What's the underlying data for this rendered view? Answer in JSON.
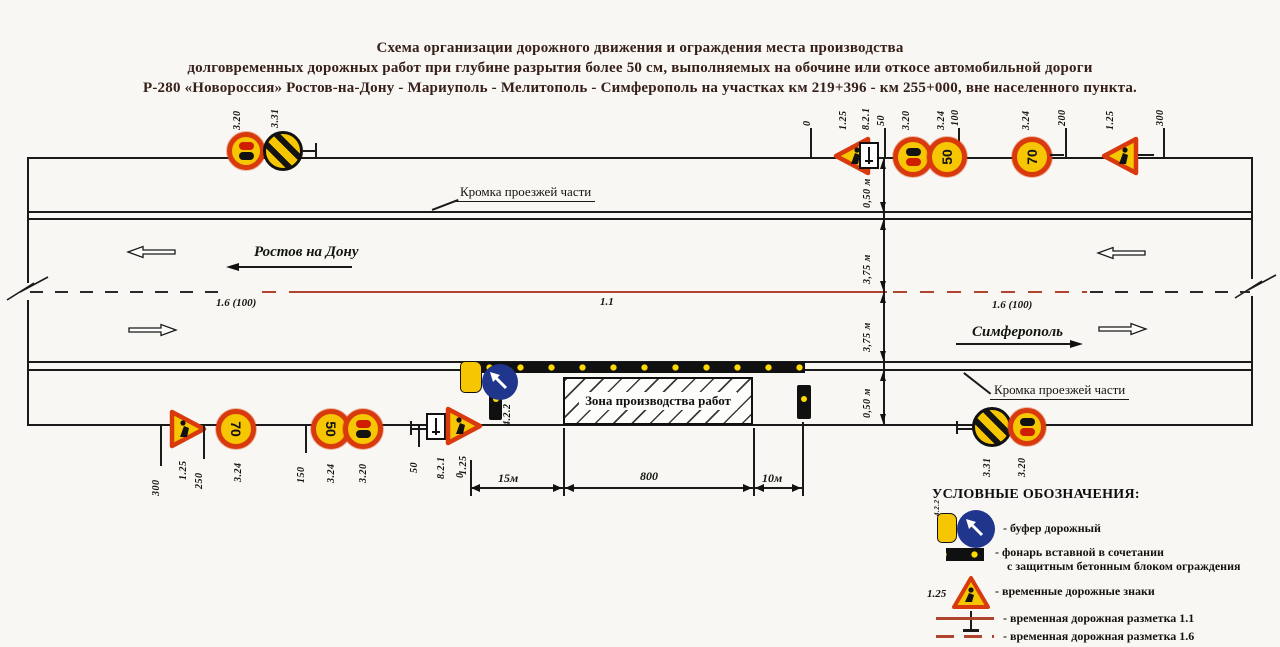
{
  "title": {
    "line1": "Схема организации дорожного движения и ограждения места производства",
    "line2": "долговременных дорожных работ при глубине разрытия более 50 см,  выполняемых на обочине или откосе автомобильной дороги",
    "line3": "Р-280 «Новороссия»  Ростов-на-Дону - Мариуполь - Мелитополь - Симферополь на участках км 219+396 - км 255+000, вне населенного пункта."
  },
  "road": {
    "kromka_top_label": "Кромка проезжей части",
    "kromka_bottom_label": "Кромка проезжей части",
    "dir_left": "Ростов на Дону",
    "dir_right": "Симферополь"
  },
  "markings": {
    "dash_left": "1.6 (100)",
    "solid_center": "1.1",
    "dash_right": "1.6 (100)"
  },
  "cross_section": [
    "0,50 м",
    "3,75 м",
    "3,75 м",
    "0,50 м"
  ],
  "stations": {
    "top": [
      "0",
      "50",
      "100",
      "200",
      "300"
    ],
    "bottom": [
      "300",
      "250",
      "150",
      "50",
      "0"
    ]
  },
  "work_zone": {
    "label": "Зона производства работ",
    "buffer_sign_label": "4.2.2",
    "zero_label": "0",
    "dims": {
      "before": "15м",
      "zone": "800",
      "after": "10м"
    }
  },
  "signs": {
    "tl": [
      {
        "id": "3.20"
      },
      {
        "id": "3.31"
      }
    ],
    "tr": [
      {
        "id": "1.25"
      },
      {
        "id": "8.2.1"
      },
      {
        "id": "3.20"
      },
      {
        "id": "3.24",
        "value": "50"
      },
      {
        "id": "3.24",
        "value": "70"
      },
      {
        "id": "1.25"
      }
    ],
    "bl": [
      {
        "id": "1.25"
      },
      {
        "id": "3.24",
        "value": "70"
      },
      {
        "id": "3.24",
        "value": "50"
      },
      {
        "id": "3.20"
      },
      {
        "id": "8.2.1"
      },
      {
        "id": "1.25"
      }
    ],
    "br": [
      {
        "id": "3.31"
      },
      {
        "id": "3.20"
      }
    ]
  },
  "legend": {
    "title": "УСЛОВНЫЕ ОБОЗНАЧЕНИЯ:",
    "items": [
      {
        "icon_label": "4.2.2",
        "text": "- буфер дорожный"
      },
      {
        "text": "- фонарь вставной  в сочетании",
        "text2": "с защитным бетонным блоком ограждения"
      },
      {
        "icon_label": "1.25",
        "text": "- временные дорожные знаки"
      },
      {
        "text": "- временная дорожная разметка 1.1"
      },
      {
        "text": "- временная дорожная разметка 1.6"
      }
    ]
  },
  "colors": {
    "marking_red": "#b0452f",
    "sign_yellow": "#f6c602",
    "sign_red": "#d8390d",
    "sign_blue": "#20368c",
    "lantern_yellow": "#ffd900"
  }
}
